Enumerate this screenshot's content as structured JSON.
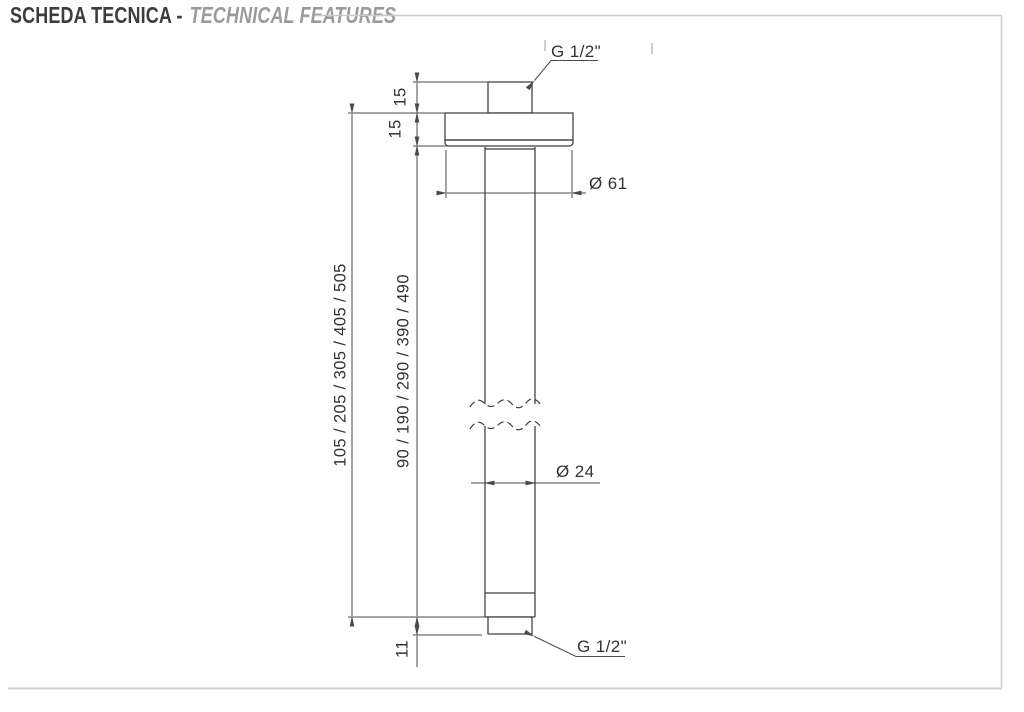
{
  "header": {
    "title_primary": "SCHEDA TECNICA -",
    "title_secondary": "TECHNICAL FEATURES"
  },
  "drawing": {
    "top_thread_label": "G 1/2\"",
    "bottom_thread_label": "G 1/2\"",
    "flange_diameter_label": "Ø 61",
    "pipe_diameter_label": "Ø 24",
    "top_fitting_height_label": "15",
    "flange_height_label": "15",
    "overall_length_label": "105 / 205 / 305 / 405 / 505",
    "pipe_length_label": "90 / 190 / 290 / 390 / 490",
    "bottom_thread_length_label": "11"
  },
  "colors": {
    "line": "#3f3f3f",
    "dim": "#4a4a4a",
    "text": "#333333",
    "frame": "#cacaca",
    "title": "#3d3d3d",
    "subtitle": "#9b9b9b"
  }
}
